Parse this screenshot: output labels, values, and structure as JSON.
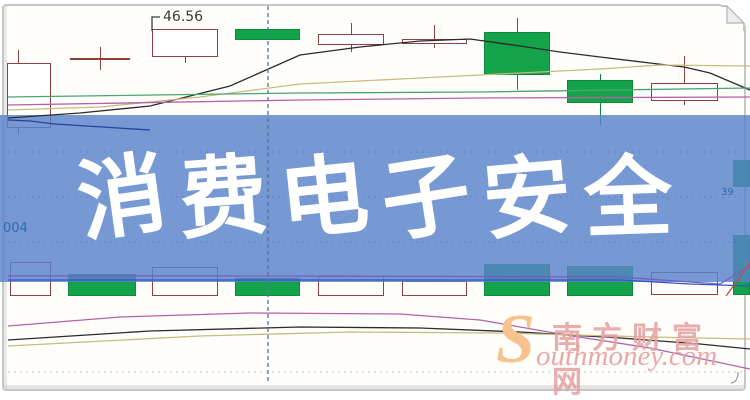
{
  "page": {
    "banner": {
      "text": "消费电子安全"
    },
    "price_label": "46.56",
    "code_left": "004",
    "code_right": "39",
    "watermark": {
      "logo_letter": "S",
      "cn": "南方财富网",
      "en": "outhmoney.com"
    }
  },
  "colors": {
    "banner_bg": "rgba(88,130,202,0.82)",
    "banner_text": "#ffffff",
    "up_border": "#8e4040",
    "up_fill": "#ffffff",
    "down_fill": "#14a24b",
    "down_border": "#0d8a3e",
    "ma_black": "#2b2b2b",
    "ma_tan": "#c9ba7f",
    "ma_green": "#4ba273",
    "ma_magenta": "#b560a8",
    "ma_blue": "#2b3f9e",
    "vol_purple": "#7a5cc0",
    "vol_blue": "#3056c6",
    "vol_red": "#cc4a4a",
    "vline": "#54749e",
    "grid_banner": "rgba(55,80,150,0.28)",
    "grid_plain": "rgba(140,140,140,0.5)",
    "label": "#3c3c3c",
    "code": "#2f6cae",
    "wm_pink": "#e5a0a0",
    "wm_orange": "#f6c38d",
    "frame": "#c6c6c6"
  },
  "chart_data": {
    "type": "candlestick_with_volume",
    "title": "消费电子安全",
    "note": "No numeric axes visible; geometry given in screen pixels. Only labeled prices are the 46.56 annotation and the partially cut right-edge label 39.",
    "price_annotation": {
      "text": "46.56",
      "points_to": [
        152,
        31
      ]
    },
    "candles": [
      {
        "cx": 18,
        "body": [
          7,
          51,
          63,
          128
        ],
        "wick_top": [
          50,
          63
        ],
        "wick_bot": [
          128,
          134
        ],
        "dir": "up"
      },
      {
        "cx": 100,
        "type": "doji",
        "x0": 70,
        "x1": 130,
        "line_y": 58,
        "wick": [
          47,
          70
        ],
        "dir": "up"
      },
      {
        "cx": 185,
        "body": [
          152,
          218,
          29,
          57
        ],
        "wick_bot": [
          57,
          63
        ],
        "dir": "up"
      },
      {
        "cx": 268,
        "body": [
          235,
          300,
          29,
          40
        ],
        "dir": "down"
      },
      {
        "cx": 351,
        "body": [
          318,
          384,
          34,
          45
        ],
        "wick_top": [
          23,
          34
        ],
        "wick_bot": [
          45,
          52
        ],
        "dir": "up"
      },
      {
        "cx": 434,
        "body": [
          402,
          467,
          39,
          44
        ],
        "wick_top": [
          25,
          39
        ],
        "wick_bot": [
          44,
          48
        ],
        "dir": "up"
      },
      {
        "cx": 517,
        "body": [
          484,
          550,
          32,
          75
        ],
        "wick_top": [
          18,
          32
        ],
        "wick_bot": [
          75,
          90
        ],
        "dir": "down"
      },
      {
        "cx": 600,
        "body": [
          567,
          633,
          80,
          103
        ],
        "wick_top": [
          74,
          80
        ],
        "wick_bot": [
          103,
          125
        ],
        "dir": "down"
      },
      {
        "cx": 684,
        "body": [
          651,
          718,
          83,
          101
        ],
        "wick_top": [
          56,
          83
        ],
        "wick_bot": [
          101,
          105
        ],
        "dir": "up"
      },
      {
        "cx": 741,
        "body": [
          733,
          750,
          160,
          187
        ],
        "dir": "down"
      }
    ],
    "volume_bars": [
      {
        "x": [
          10,
          51
        ],
        "y": [
          262,
          296
        ],
        "dir": "up"
      },
      {
        "x": [
          68,
          136
        ],
        "y": [
          274,
          296
        ],
        "dir": "down"
      },
      {
        "x": [
          152,
          218
        ],
        "y": [
          267,
          296
        ],
        "dir": "up"
      },
      {
        "x": [
          235,
          300
        ],
        "y": [
          278,
          296
        ],
        "dir": "down"
      },
      {
        "x": [
          318,
          384
        ],
        "y": [
          276,
          296
        ],
        "dir": "up"
      },
      {
        "x": [
          402,
          467
        ],
        "y": [
          281,
          296
        ],
        "dir": "up"
      },
      {
        "x": [
          484,
          550
        ],
        "y": [
          264,
          296
        ],
        "dir": "down"
      },
      {
        "x": [
          567,
          633
        ],
        "y": [
          266,
          296
        ],
        "dir": "down"
      },
      {
        "x": [
          651,
          718
        ],
        "y": [
          272,
          295
        ],
        "dir": "up"
      },
      {
        "x": [
          733,
          750
        ],
        "y": [
          235,
          295
        ],
        "dir": "down"
      }
    ],
    "lines": [
      {
        "name": "ma-black-top",
        "color_key": "ma_black",
        "points": [
          [
            8,
            118
          ],
          [
            80,
            113
          ],
          [
            150,
            106
          ],
          [
            230,
            86
          ],
          [
            300,
            55
          ],
          [
            360,
            47
          ],
          [
            420,
            41
          ],
          [
            470,
            39
          ],
          [
            520,
            46
          ],
          [
            560,
            52
          ],
          [
            600,
            57
          ],
          [
            650,
            63
          ],
          [
            684,
            67
          ],
          [
            710,
            73
          ],
          [
            750,
            90
          ]
        ]
      },
      {
        "name": "ma-tan-top",
        "color_key": "ma_tan",
        "points": [
          [
            8,
            110
          ],
          [
            100,
            107
          ],
          [
            200,
            97
          ],
          [
            300,
            84
          ],
          [
            400,
            79
          ],
          [
            480,
            75
          ],
          [
            600,
            69
          ],
          [
            660,
            65
          ],
          [
            750,
            66
          ]
        ]
      },
      {
        "name": "ma-green-top",
        "color_key": "ma_green",
        "points": [
          [
            8,
            97
          ],
          [
            300,
            93
          ],
          [
            480,
            92
          ],
          [
            750,
            88
          ]
        ]
      },
      {
        "name": "ma-magenta-top",
        "color_key": "ma_magenta",
        "points": [
          [
            8,
            105
          ],
          [
            300,
            100
          ],
          [
            480,
            98
          ],
          [
            750,
            97
          ]
        ]
      },
      {
        "name": "ma-blue-top",
        "color_key": "ma_blue",
        "points": [
          [
            8,
            120
          ],
          [
            30,
            121
          ],
          [
            55,
            124
          ],
          [
            150,
            130
          ]
        ]
      },
      {
        "name": "vol-ma-purple",
        "color_key": "vol_purple",
        "points": [
          [
            8,
            276
          ],
          [
            300,
            276
          ],
          [
            620,
            277
          ],
          [
            690,
            282
          ],
          [
            720,
            284
          ],
          [
            750,
            266
          ]
        ]
      },
      {
        "name": "vol-ma-blue",
        "color_key": "vol_blue",
        "points": [
          [
            8,
            280
          ],
          [
            300,
            280
          ],
          [
            620,
            280
          ],
          [
            690,
            284
          ],
          [
            750,
            286
          ]
        ]
      },
      {
        "name": "vol-ma-red",
        "color_key": "vol_red",
        "points": [
          [
            726,
            296
          ],
          [
            750,
            263
          ]
        ]
      },
      {
        "name": "ma-magenta-bottom",
        "color_key": "ma_magenta",
        "points": [
          [
            8,
            326
          ],
          [
            120,
            317
          ],
          [
            250,
            313
          ],
          [
            400,
            314
          ],
          [
            480,
            320
          ],
          [
            560,
            334
          ],
          [
            650,
            348
          ],
          [
            750,
            369
          ]
        ]
      },
      {
        "name": "ma-black-bottom",
        "color_key": "ma_black",
        "points": [
          [
            8,
            340
          ],
          [
            150,
            331
          ],
          [
            300,
            327
          ],
          [
            420,
            328
          ],
          [
            520,
            332
          ],
          [
            620,
            338
          ],
          [
            700,
            344
          ],
          [
            750,
            349
          ]
        ]
      },
      {
        "name": "ma-tan-bottom",
        "color_key": "ma_tan",
        "points": [
          [
            8,
            346
          ],
          [
            200,
            336
          ],
          [
            350,
            332
          ],
          [
            500,
            333
          ],
          [
            650,
            337
          ],
          [
            750,
            339
          ]
        ]
      },
      {
        "name": "price-pointer",
        "color_key": "label",
        "points": [
          [
            152,
            31
          ],
          [
            152,
            17
          ],
          [
            160,
            17
          ]
        ]
      }
    ],
    "vline_x": 268,
    "gridlines": [
      {
        "y": 152,
        "color_key": "grid_banner"
      },
      {
        "y": 197,
        "color_key": "grid_banner"
      },
      {
        "y": 242,
        "color_key": "grid_banner"
      },
      {
        "y": 372,
        "color_key": "grid_plain"
      }
    ],
    "banner_band": [
      115,
      282
    ]
  }
}
